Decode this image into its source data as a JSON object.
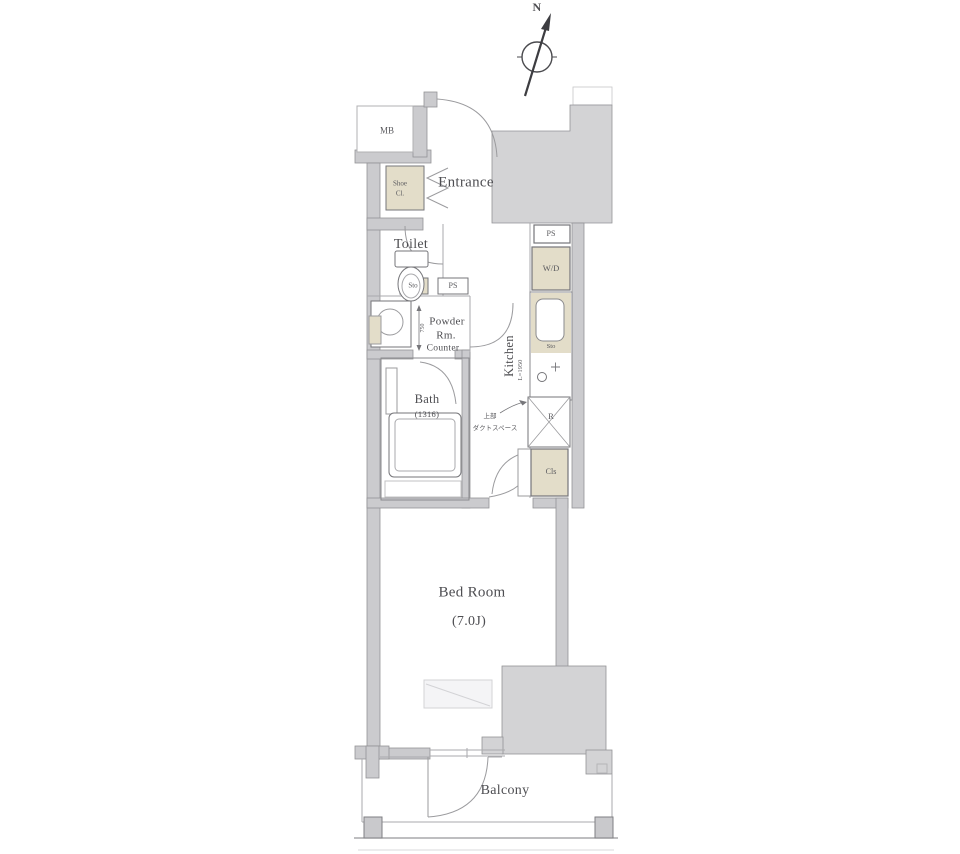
{
  "compass": {
    "n": "N"
  },
  "labels": {
    "mb": "MB",
    "entrance": "Entrance",
    "shoe1": "Shoe",
    "shoe2": "Cl.",
    "toilet": "Toilet",
    "sto_toilet": "Sto",
    "ps_hall": "PS",
    "ps_kitchen": "PS",
    "wd": "W/D",
    "powder1": "Powder",
    "powder2": "Rm.",
    "counter": "Counter",
    "dim750": "750",
    "kitchen": "Kitchen",
    "kitchen_dim": "L=1950",
    "sto_kitchen": "Sto",
    "bath": "Bath",
    "bath_size": "(1316)",
    "fridge": "R",
    "duct1": "上部",
    "duct2": "ダクトスペース",
    "closet": "Cls",
    "bedroom": "Bed Room",
    "bedroom_size": "(7.0J)",
    "balcony": "Balcony"
  },
  "colors": {
    "wall_fill": "#cbcbce",
    "block_fill": "#d3d3d5",
    "fixture_beige": "#e3ddc9",
    "line_gray": "#9b9b9e",
    "text": "#4e4e52"
  }
}
